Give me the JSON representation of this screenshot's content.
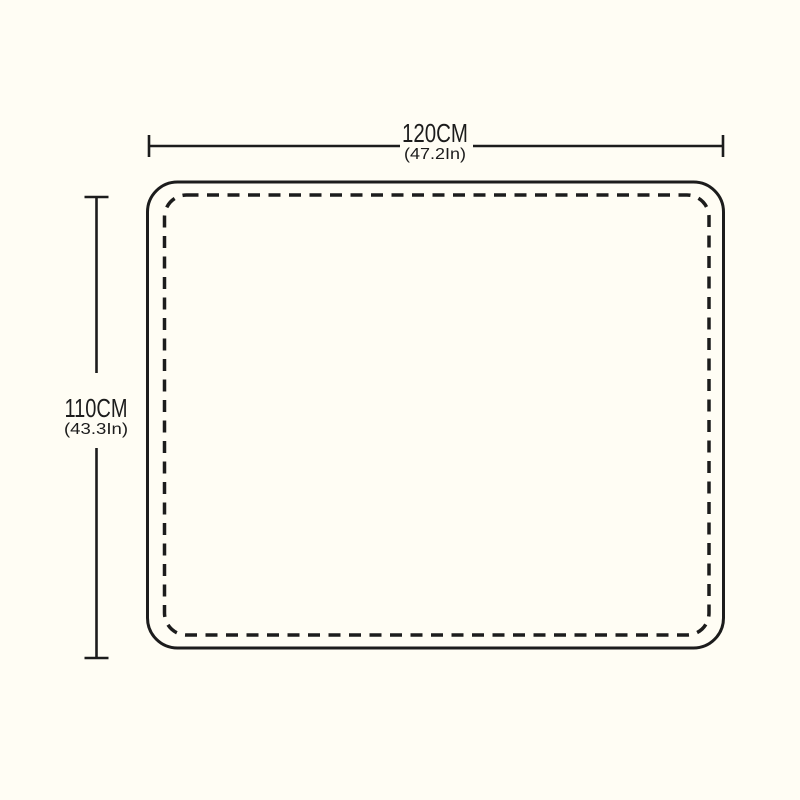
{
  "colors": {
    "background": "#FFFDF4",
    "line": "#1C1C1C"
  },
  "diagram": {
    "width_dimension": {
      "cm_label": "120CM",
      "inch_label": "(47.2In)"
    },
    "height_dimension": {
      "cm_label": "110CM",
      "inch_label": "(43.3In)"
    }
  }
}
